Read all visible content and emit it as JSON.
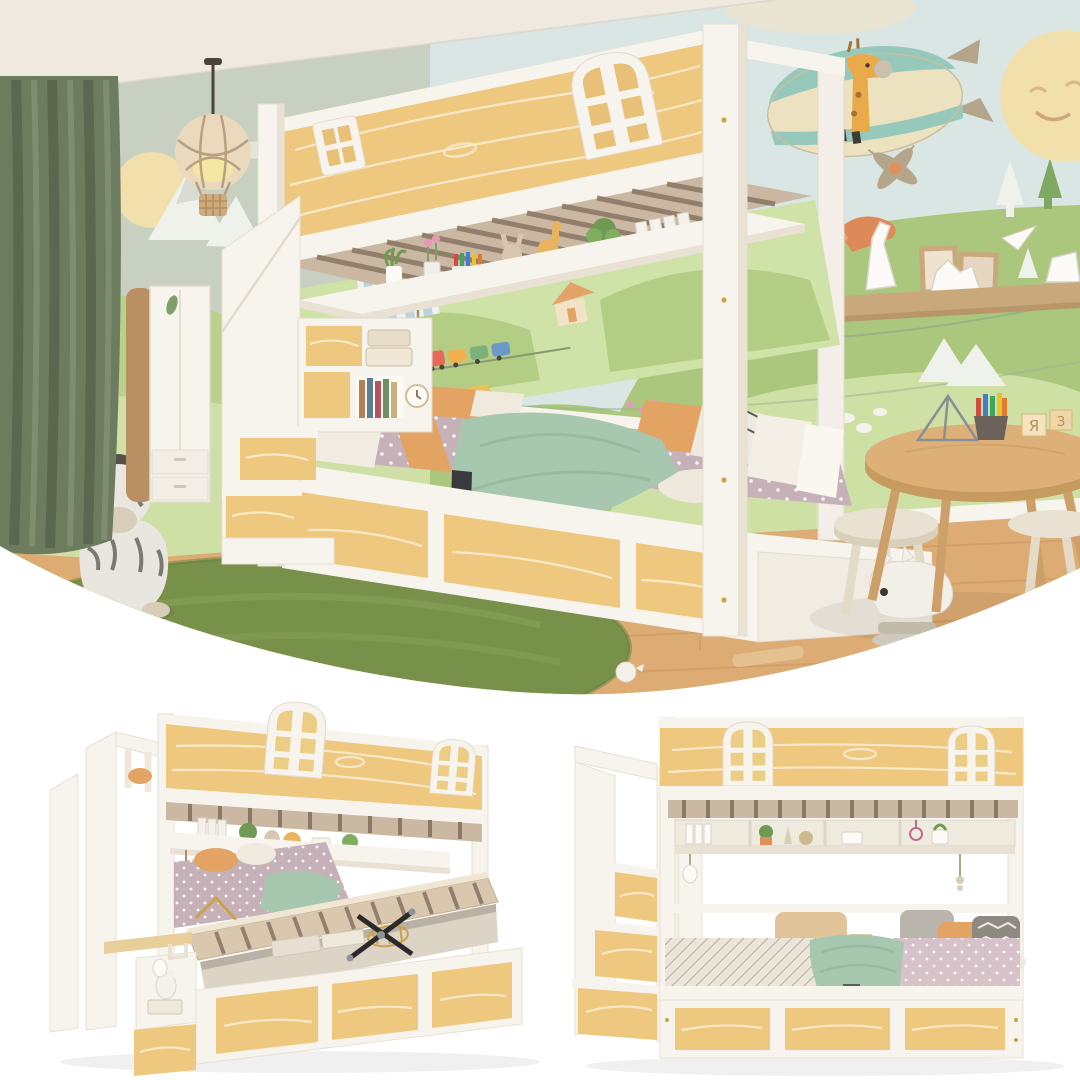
{
  "meta": {
    "media_type": "product-photo-collage",
    "subject": "kids house-shaped bunk bed with storage staircase, three photos"
  },
  "palette": {
    "sky": "#d9e6e3",
    "ceiling": "#efe9e0",
    "wallLeft": "#c7d0c1",
    "curtain": "#6d7b5f",
    "curtainDark": "#57644c",
    "curtainLight": "#879274",
    "floor": "#ddac74",
    "floorLine": "#c9965f",
    "rug": "#77904a",
    "rugLine": "#8ba65e",
    "wood": "#eec87f",
    "woodGrain": "#f8ecd2",
    "white": "#f7f4ee",
    "whiteShade": "#e8e1d4",
    "whiteDeep": "#d9d1c2",
    "slatBase": "#cbb8a2",
    "slatDark": "#8b7866",
    "hillBack": "#abc77d",
    "hillFront": "#cfe0a4",
    "muralBand": "#cfe2a8",
    "pine": "#7fa863",
    "pineSnow": "#eef2ea",
    "sun": "#f2e0ac",
    "zepCream": "#ece2bf",
    "zepTeal": "#96c8bc",
    "fin": "#b5a58b",
    "giraffe": "#e9ab49",
    "mattress": "#c7b1b8",
    "mattressPink": "#d8c2ca",
    "sheetDiamond": "#ece6da",
    "blanket": "#a7c7af",
    "pOrange": "#e2a363",
    "pGray": "#b9b4ac",
    "pDark": "#8e8a82",
    "sheet": "#f1ebe2",
    "strap": "#3a3a3c",
    "strapGray": "#5a5e61",
    "tableWood": "#dcb077",
    "stool": "#e9e2d2",
    "plush": "#f2efe9",
    "shelfWood": "#c9a87c",
    "fox": "#dd8a58",
    "house": "#f1e3c6",
    "roof": "#e2a368"
  },
  "photos": {
    "lifestyle": {
      "name": "kids bedroom lifestyle scene",
      "objects": [
        "balloon-pendant-lamp",
        "green-curtain",
        "wardrobe",
        "wall-mural-zeppelin-giraffe",
        "smiling-sun",
        "bunk-bed",
        "arched-windows",
        "storage-staircase",
        "under-bunk-shelf",
        "lower-bed-with-bedding",
        "drawer-base",
        "green-rug",
        "zebra-plush",
        "kids-round-table",
        "stools",
        "ride-on-plush",
        "wall-shelf-with-origami",
        "wood-floor"
      ],
      "block_letters": [
        "Я",
        "З"
      ]
    },
    "product_left": {
      "name": "bunk bed with lift-up hydraulic storage platform",
      "objects": [
        "staircase",
        "arched-windows",
        "under-bunk-shelf",
        "lifted-slat-platform",
        "gas-struts",
        "storage-boxes",
        "drawer-base",
        "bedding-heap"
      ]
    },
    "product_right": {
      "name": "bunk bed front view with made bed",
      "objects": [
        "staircase",
        "arched-windows",
        "under-bunk-shelf",
        "pillows",
        "blanket",
        "drawer-base",
        "hanging-toys"
      ]
    }
  }
}
